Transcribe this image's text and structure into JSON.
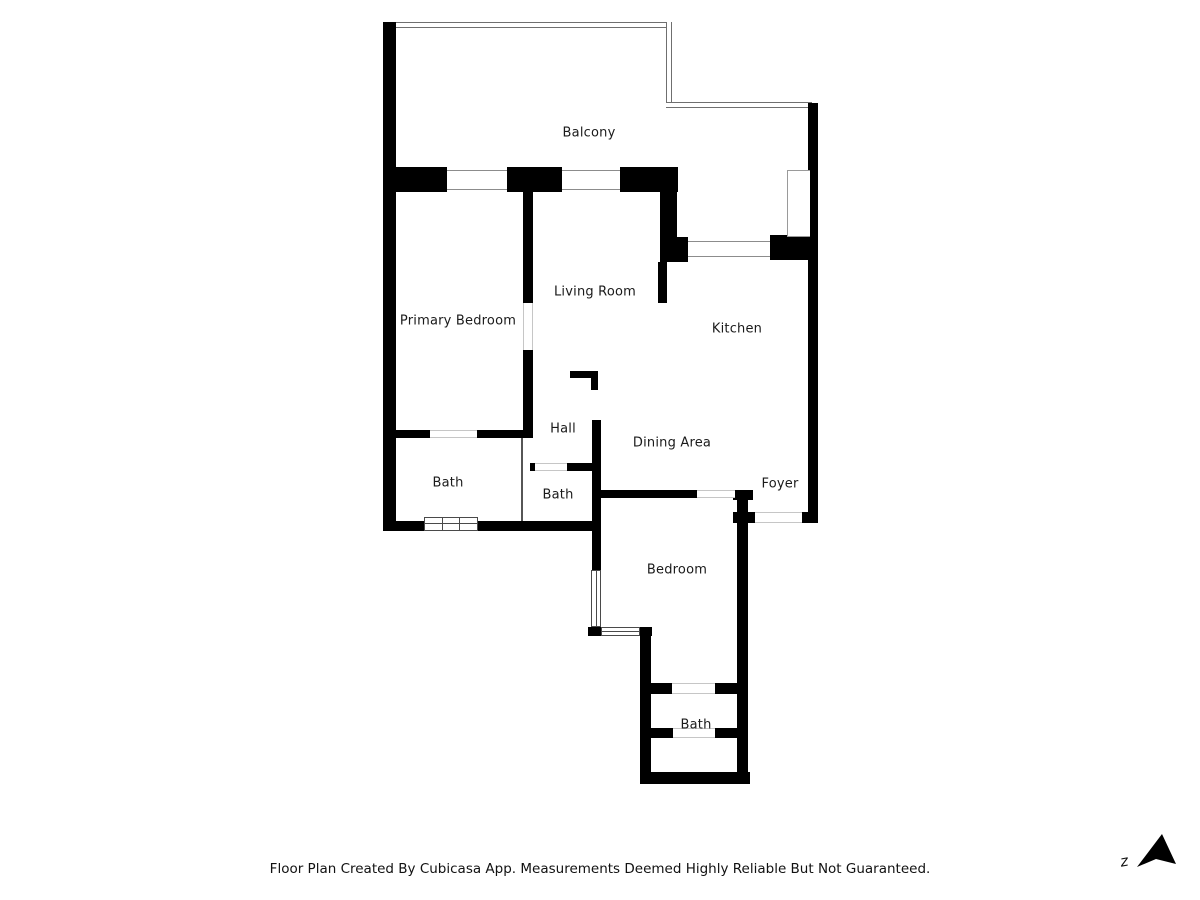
{
  "rooms": {
    "balcony": "Balcony",
    "primary_bedroom": "Primary Bedroom",
    "living_room": "Living Room",
    "kitchen": "Kitchen",
    "hall": "Hall",
    "dining_area": "Dining Area",
    "foyer": "Foyer",
    "bath_primary": "Bath",
    "bath_hall": "Bath",
    "bedroom": "Bedroom",
    "bath_lower": "Bath"
  },
  "footer": {
    "disclaimer": "Floor Plan Created By Cubicasa App. Measurements Deemed Highly Reliable But Not Guaranteed."
  },
  "compass": {
    "north_label": "z"
  },
  "colors": {
    "wall": "#000000",
    "thin_line": "#6f6f6f",
    "text": "#1a1a1a",
    "background": "#ffffff"
  }
}
